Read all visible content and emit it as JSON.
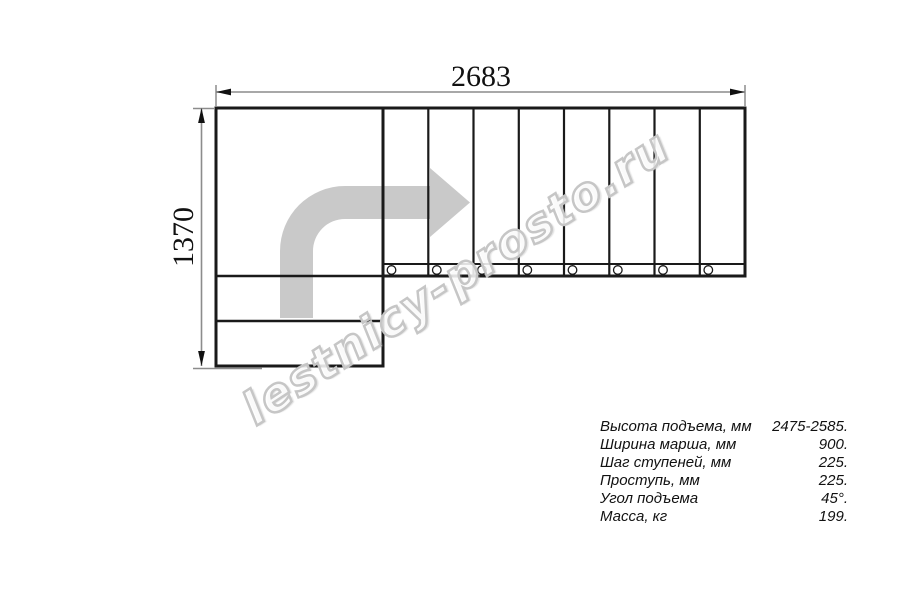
{
  "drawing": {
    "title": "staircase-plan-top-view",
    "dim_width_label": "2683",
    "dim_height_label": "1370",
    "tread_count": 8,
    "direction_arrow_icon": "turn-right-arrow",
    "colors": {
      "line": "#1a1a1a",
      "dimension_line": "#8c8c8c",
      "arrow_fill": "#c9c9c9",
      "watermark_outline": "#c6c6c6"
    }
  },
  "watermark": {
    "text": "lestnicy-prosto.ru"
  },
  "specs": {
    "rows": [
      {
        "label": "Высота подъема, мм",
        "value": "2475-2585."
      },
      {
        "label": "Ширина марша, мм",
        "value": "900."
      },
      {
        "label": "Шаг ступеней, мм",
        "value": "225."
      },
      {
        "label": "Проступь, мм",
        "value": "225."
      },
      {
        "label": "Угол подъема",
        "value": "45°."
      },
      {
        "label": "Масса, кг",
        "value": "199."
      }
    ]
  }
}
